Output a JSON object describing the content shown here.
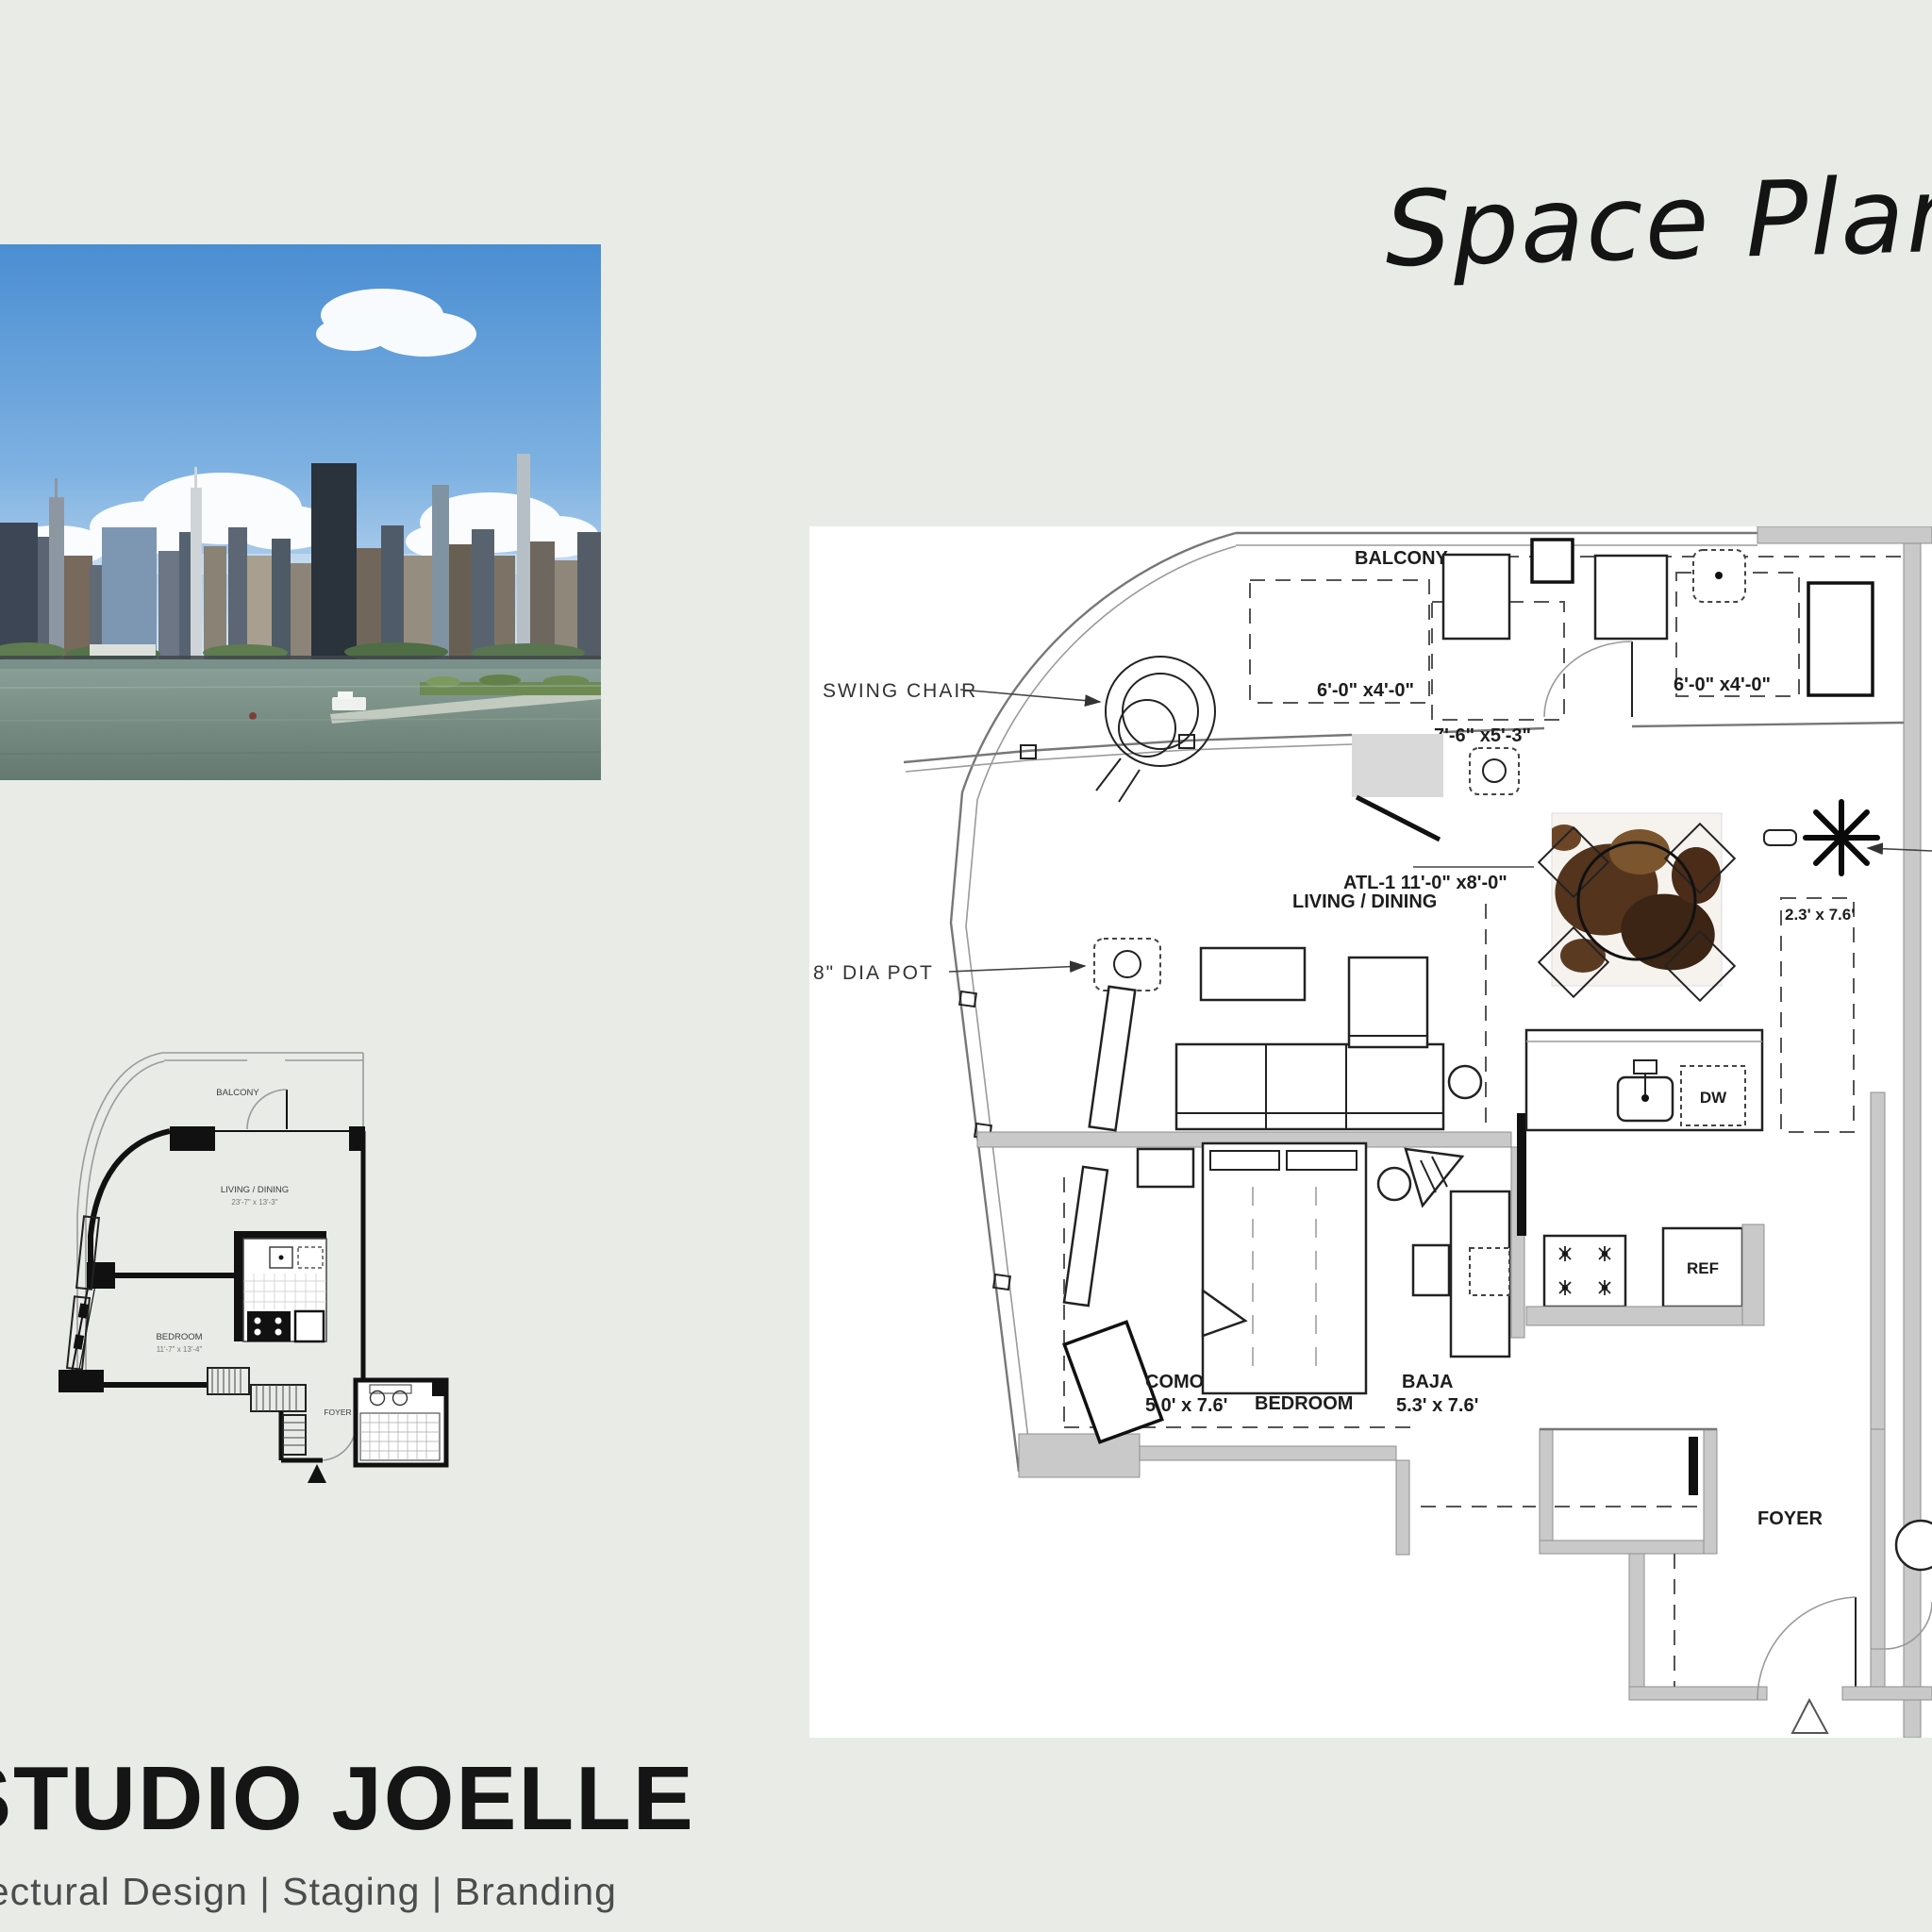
{
  "title": {
    "text": "Space Planning"
  },
  "brand": {
    "name": "STUDIO JOELLE",
    "tagline": "Architectural Design | Staging | Branding"
  },
  "photo": {
    "alt": "Manhattan skyline across the river"
  },
  "plan": {
    "labels": {
      "swing_chair": "SWING CHAIR",
      "dia_pot": "8\" DIA POT",
      "balcony": "BALCONY",
      "rug_left": "6'-0\" x4'-0\"",
      "rug_mid": "7'-6\" x5'-3\"",
      "rug_right": "6'-0\" x4'-0\"",
      "living_rug": "ATL-1  11'-0\" x8'-0\"",
      "living_dining": "LIVING / DINING",
      "runner": "2.3' x 7.6'",
      "como": "COMO",
      "como_dim": "5.0' x 7.6'",
      "bedroom": "BEDROOM",
      "baja": "BAJA",
      "baja_dim": "5.3' x 7.6'",
      "dw": "DW",
      "ref": "REF",
      "foyer": "FOYER"
    }
  },
  "mini_plan": {
    "labels": {
      "balcony": "BALCONY",
      "living_dining": "LIVING / DINING",
      "living_dim": "23'-7\" x 13'-3\"",
      "bedroom": "BEDROOM",
      "bedroom_dim": "11'-7\" x 13'-4\"",
      "foyer": "FOYER"
    }
  },
  "colors": {
    "background": "#e9ebe7",
    "panel": "#ffffff",
    "wall": "#c9c9c9",
    "line": "#222222"
  }
}
